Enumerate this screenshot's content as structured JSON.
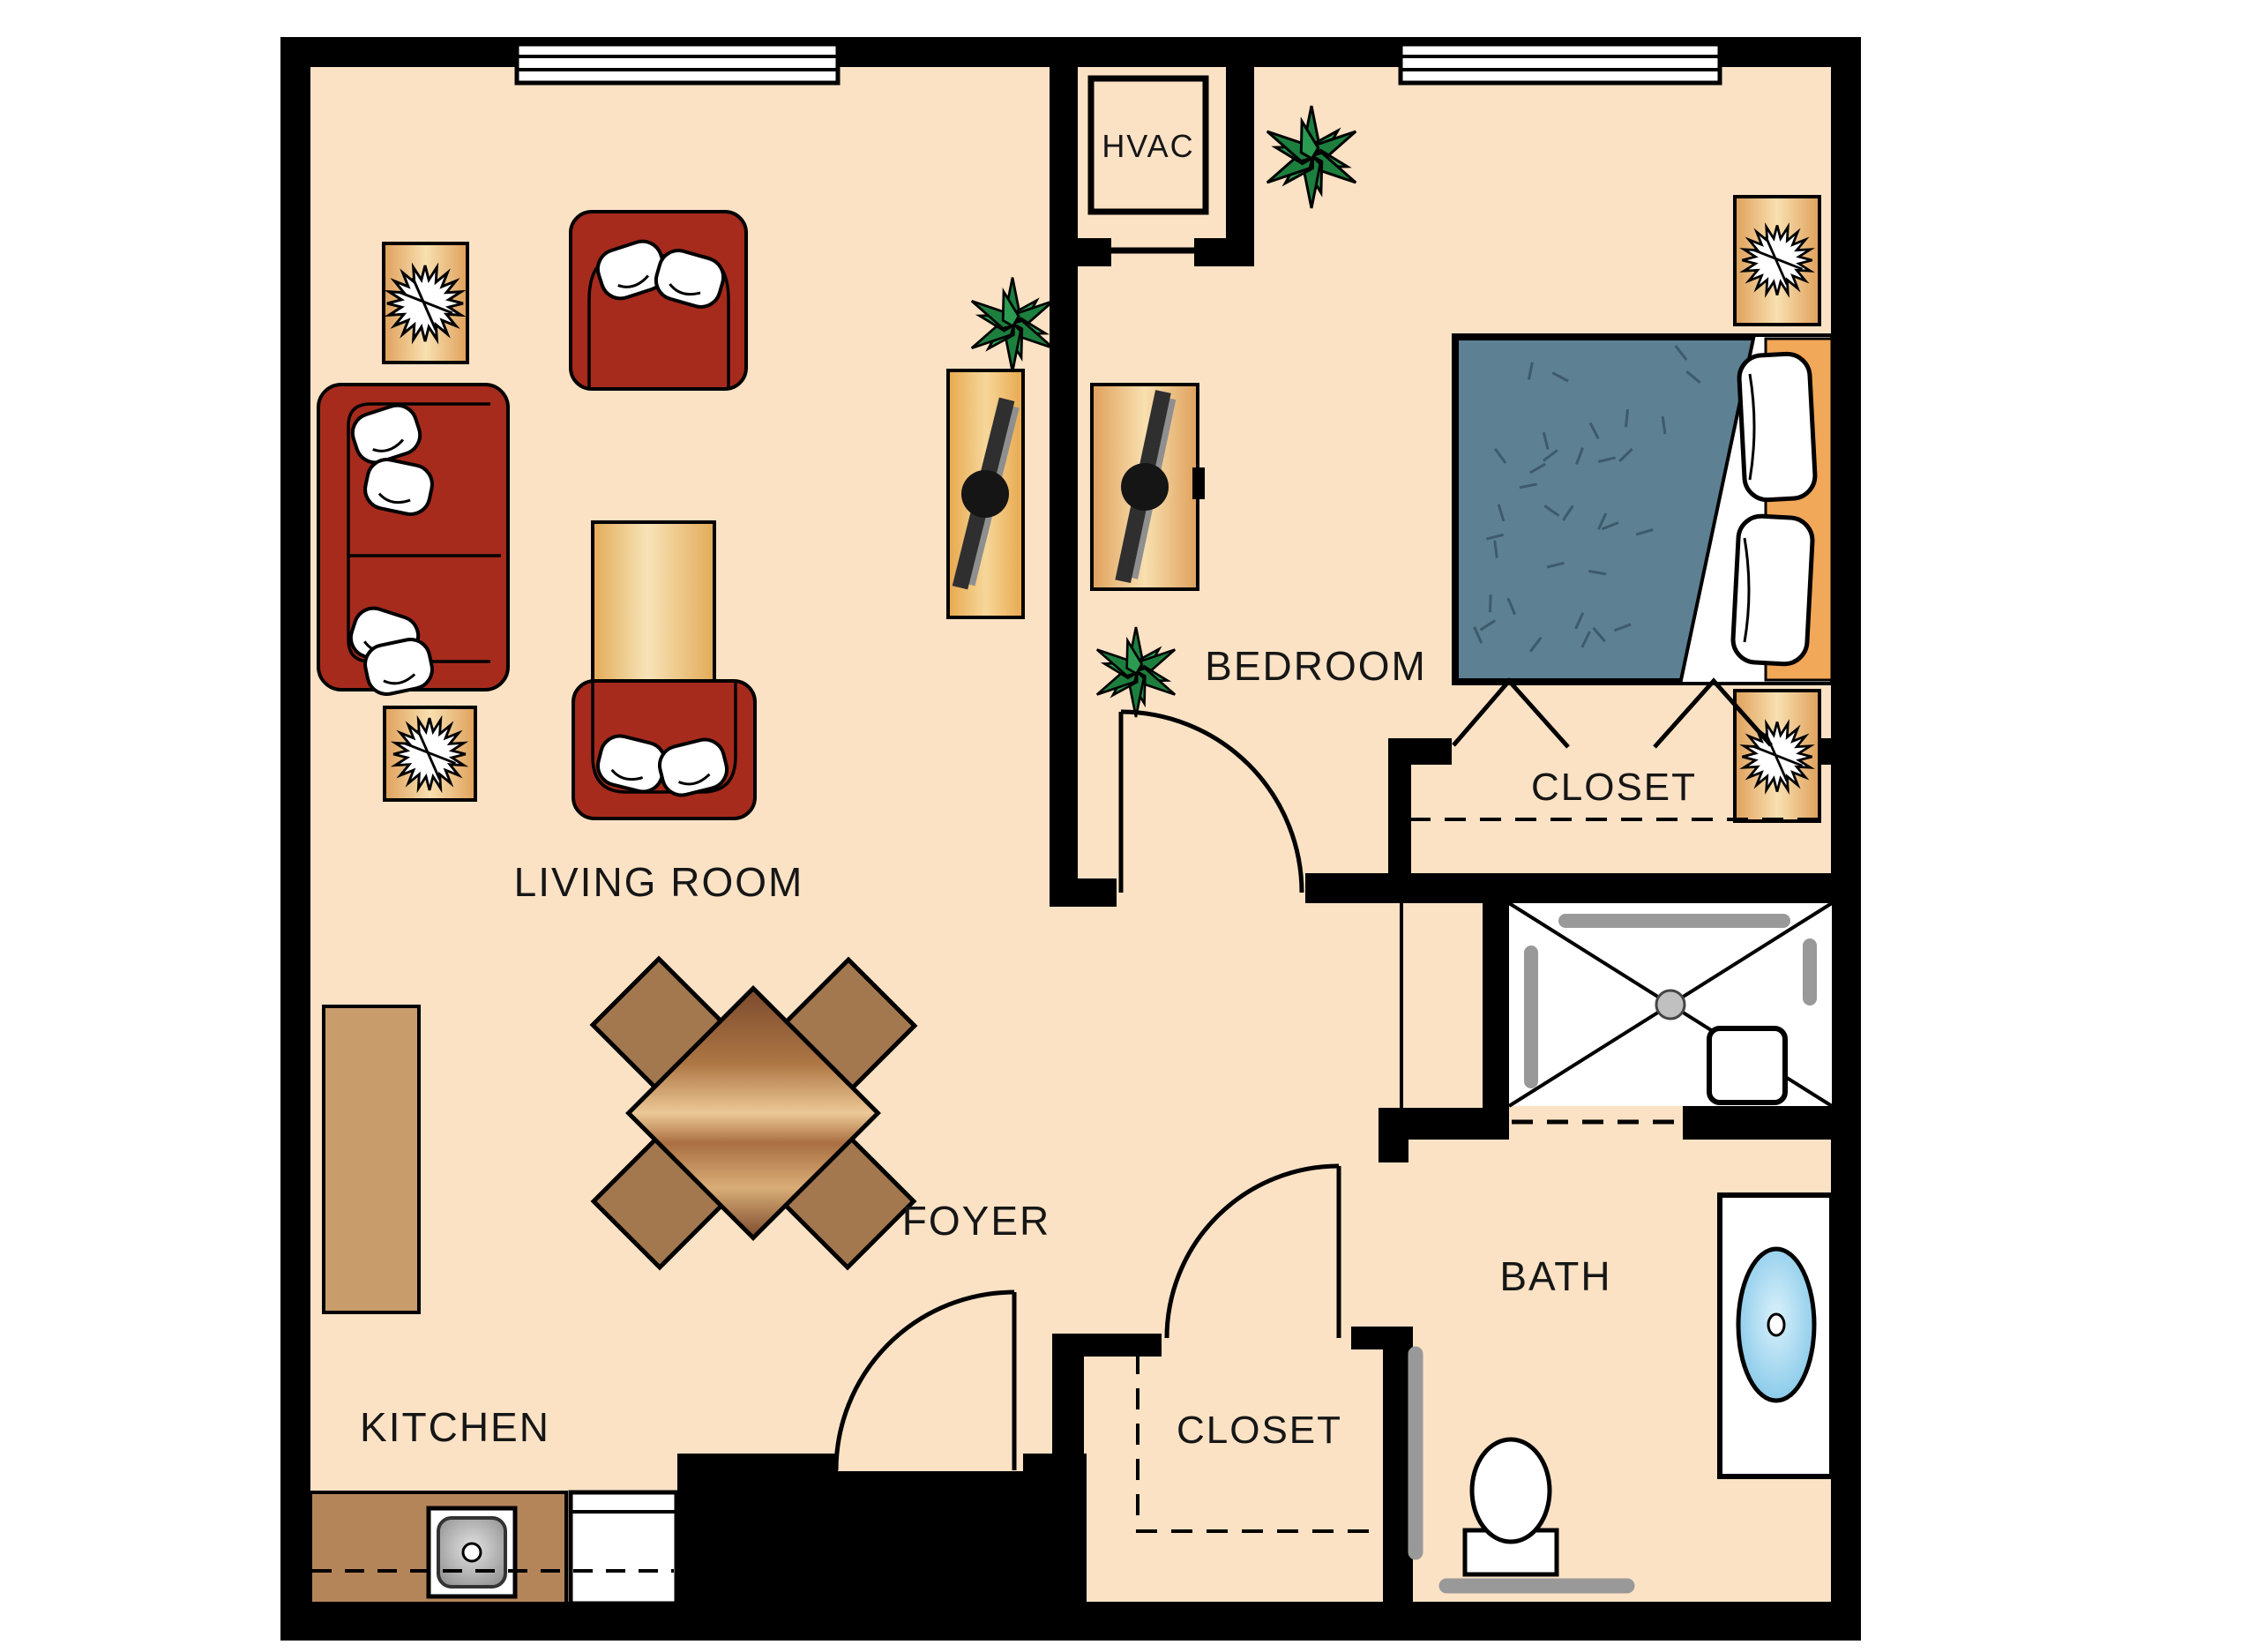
{
  "plan": {
    "type": "floor-plan",
    "rooms": [
      {
        "id": "living-room",
        "label": "LIVING ROOM"
      },
      {
        "id": "bedroom",
        "label": "BEDROOM"
      },
      {
        "id": "kitchen",
        "label": "KITCHEN"
      },
      {
        "id": "foyer",
        "label": "FOYER"
      },
      {
        "id": "bath",
        "label": "BATH"
      },
      {
        "id": "bedroom-closet",
        "label": "CLOSET"
      },
      {
        "id": "foyer-closet",
        "label": "CLOSET"
      },
      {
        "id": "hvac-closet",
        "label": "HVAC"
      }
    ],
    "fixtures": [
      "sofa",
      "armchair",
      "coffee-table",
      "side-table",
      "sunburst-lamp",
      "tv-console",
      "tv",
      "dining-table",
      "dining-chair",
      "kitchen-counter",
      "kitchen-sink",
      "range",
      "kitchen-island",
      "bed",
      "bed-pillow",
      "nightstand",
      "potted-plant",
      "shower",
      "shower-seat",
      "grab-bar",
      "drain",
      "toilet",
      "vanity",
      "bathroom-sink",
      "window",
      "swing-door",
      "bifold-closet-door",
      "dashed-storage-outline"
    ],
    "palette": {
      "floor": "#fbe2c5",
      "wall": "#000000",
      "furniture_red": "#a62b1d",
      "wood_light": "#f3d9a3",
      "wood_mid": "#c9996b",
      "wood_dark": "#8a5a33",
      "counter_brown": "#b5855a",
      "island_brown": "#c99c6c",
      "chair_brown": "#a4784e",
      "bed_blanket": "#5d8093",
      "headboard_orange": "#f2a859",
      "plant_green": "#1c7f3e",
      "bar_gray": "#999999",
      "sink_blue": "#74c0e8"
    }
  }
}
